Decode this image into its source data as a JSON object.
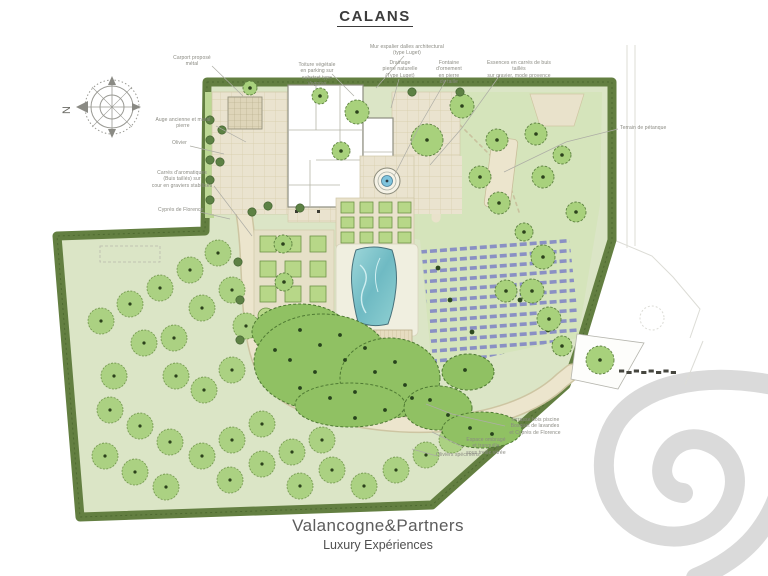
{
  "title": "CALANS",
  "compass": {
    "north_letter": "N"
  },
  "annotations": {
    "carport": "Carport proposé\nmétal",
    "toiture": "Toiture végétale\nen parking sur\nsubstrat type Vegpras",
    "mur": "Mur espalier dalles architectural\n(type Luget)",
    "drainage": "Drainage\npierre naturelle\n(Type Luget)",
    "fontaine": "Fontaine d'ornement\nen pierre\nde taille",
    "essences": "Essences en carrés de buis taillés\nsur gravier, mode provence",
    "auge": "Auge ancienne et mural\npierre",
    "olivier": "Olivier",
    "aromatiques": "Carrés d'aromatiques\n(Buis taillés) sur\ncour en graviers stabilisés",
    "cypres": "Cyprès de Florence",
    "petanque": "Terrain de pétanque",
    "terrasse_piscine": "Terrasse bois piscine\nBosquet de lavandes\net Cyprès de Florence",
    "espace_ombrage": "Espace ombragé\net tranquille\nsous treille vitrée",
    "oliviers": "Oliviers spécimens"
  },
  "footer": {
    "brand": "Valancogne&Partners",
    "tagline": "Luxury Expériences"
  },
  "colors": {
    "site_green": "#dbe5c6",
    "hedge_green": "#637f41",
    "tree_green": "#a8d17c",
    "canopy_green": "#90c163",
    "pool_water": "#7cc4cb",
    "lavender": "#8a90c4",
    "paving_tan": "#eae3cf",
    "watermark_gray": "#dadada",
    "label_gray": "#8a8a82"
  }
}
